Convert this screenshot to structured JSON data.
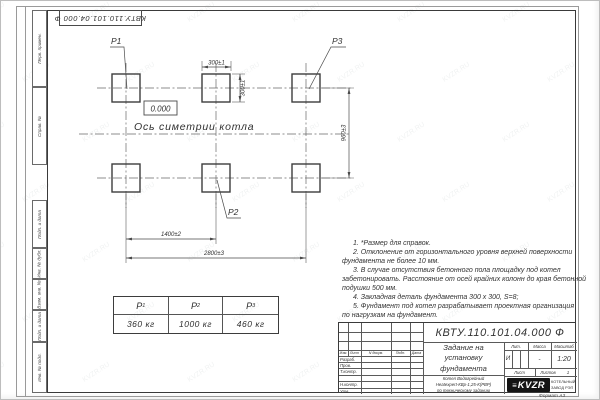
{
  "stamp": {
    "designation_top": "КВТУ.110.101.04.000  Ф"
  },
  "margin_labels": {
    "perv_primen": "Перв. примен.",
    "sprav_n": "Справ. №",
    "podp_data_1": "Подп. и дата",
    "inv_dubl": "Инв. № дубл.",
    "vzam_inv": "Взам. инв. №",
    "podp_data_2": "Подп. и дата",
    "inv_podl": "Инв. № подл."
  },
  "drawing": {
    "labels": {
      "p1": "P1",
      "p2": "P2",
      "p3": "P3"
    },
    "elevation": "0.000",
    "axis_label": "Ось симетрии котла",
    "dims": {
      "pad_width": "300±1",
      "pad_height": "300±1",
      "row_spacing": "960±3",
      "col_spacing": "1400±2",
      "total_span": "2800±3"
    }
  },
  "load_table": {
    "headers": [
      {
        "base": "P",
        "sub": "1"
      },
      {
        "base": "P",
        "sub": "2"
      },
      {
        "base": "P",
        "sub": "3"
      }
    ],
    "values": [
      "360 кг",
      "1000 кг",
      "460 кг"
    ]
  },
  "notes": [
    {
      "text": "1. *Размер для справок."
    },
    {
      "text": "2. Отклонение от горизонтального уровня верхней поверхности"
    },
    {
      "text": "фундамента не более 10 мм."
    },
    {
      "text": "3. В случае отсутствия бетонного пола площадку под котел"
    },
    {
      "text": "забетонировать. Расстояние от осей крайних колонн до края бетонной"
    },
    {
      "text": "подушки 500 мм."
    },
    {
      "text": "4. Закладная деталь фундамента  300 х 300, S=8;"
    },
    {
      "text": "5. Фундамент под котел разрабатывает проектная организация"
    },
    {
      "text": "по нагрузкам на фундамент."
    }
  ],
  "title_block": {
    "designation": "КВТУ.110.101.04.000  Ф",
    "doc_title": "Задание на установку фундамента",
    "product_lines": [
      "Котел Водогрейный",
      "Heatexpert-КВр-1,25-К(РВР)",
      "по техническому заданию"
    ],
    "col_headers": {
      "izm": "Изм.",
      "list": "Лист",
      "ndoc": "N докум.",
      "podp": "Подп.",
      "data": "Дата"
    },
    "roles": [
      "Разраб.",
      "Пров.",
      "Т.контр.",
      "Н.контр.",
      "Утв."
    ],
    "lit_header": "Лит.",
    "mass_header": "Масса",
    "scale_header": "Масштаб",
    "lit_value": "И",
    "mass_value": "-",
    "scale_value": "1:20",
    "sheet_label": "Лист",
    "sheets_label": "Листов",
    "sheets_value": "1",
    "logo_glyph": "≡",
    "logo_text": "KVZR",
    "company_lines": [
      "КОТЕЛЬНЫЙ",
      "ЗАВОД РЭП"
    ],
    "format_note": "Формат А3"
  },
  "watermark": {
    "text": "KVZR.RU"
  }
}
